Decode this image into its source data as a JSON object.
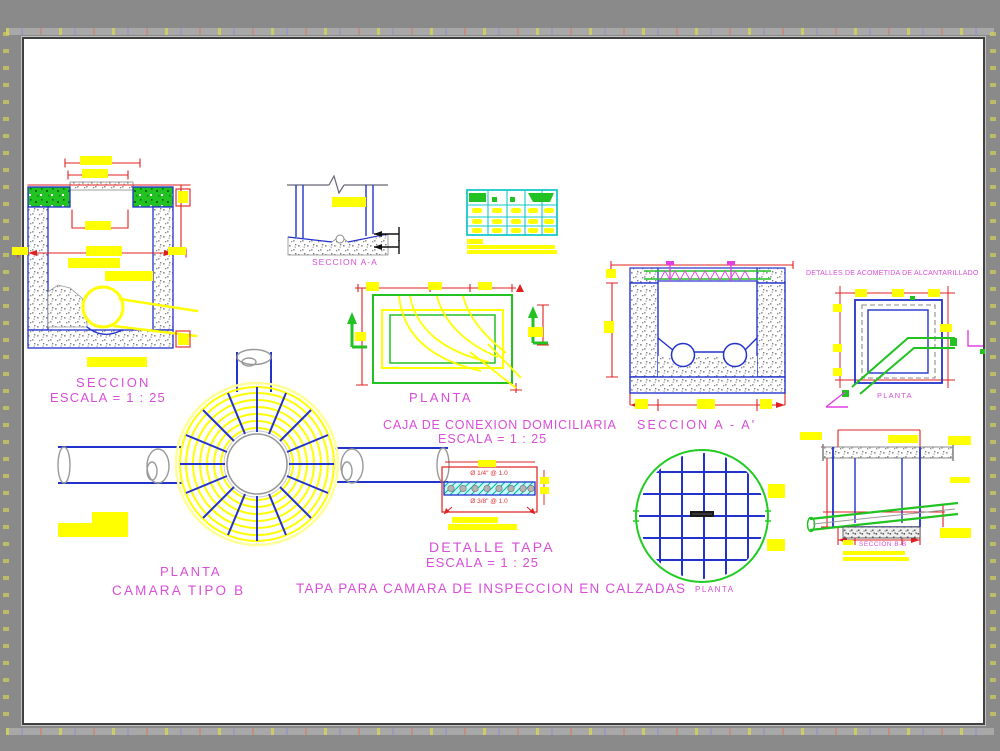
{
  "colors": {
    "label_magenta": "#d94ed9",
    "line_blue": "#2233cc",
    "dim_red": "#e02020",
    "annotation_yellow": "#ffff00",
    "line_green": "#23c223",
    "table_cyan": "#17c8c8",
    "canvas_white": "#ffffff",
    "surround_gray": "#8a8a8a"
  },
  "drawings": {
    "seccion_camara": {
      "title": "SECCION",
      "scale": "ESCALA = 1 : 25"
    },
    "seccion_aa_detail": {
      "label": "SECCION A-A"
    },
    "caja_conexion": {
      "plan_label": "PLANTA",
      "title": "CAJA DE CONEXION DOMICILIARIA",
      "section_label": "SECCION A - A'",
      "scale": "ESCALA = 1 : 25"
    },
    "acometida": {
      "title": "DETALLES DE ACOMETIDA DE ALCANTARILLADO",
      "plan_label": "PLANTA"
    },
    "camara_tipo_b": {
      "plan_label": "PLANTA",
      "title": "CAMARA TIPO B"
    },
    "detalle_tapa": {
      "title": "DETALLE TAPA",
      "scale": "ESCALA = 1 : 25",
      "rebar_top": "Ø 1/4\" @ 1.0",
      "rebar_bottom": "Ø 3/8\" @ 1.0"
    },
    "tapa_calzadas": {
      "title": "TAPA PARA CAMARA DE INSPECCION EN CALZADAS",
      "plan_label": "PLANTA",
      "section_label": "SECCION B-B"
    }
  }
}
